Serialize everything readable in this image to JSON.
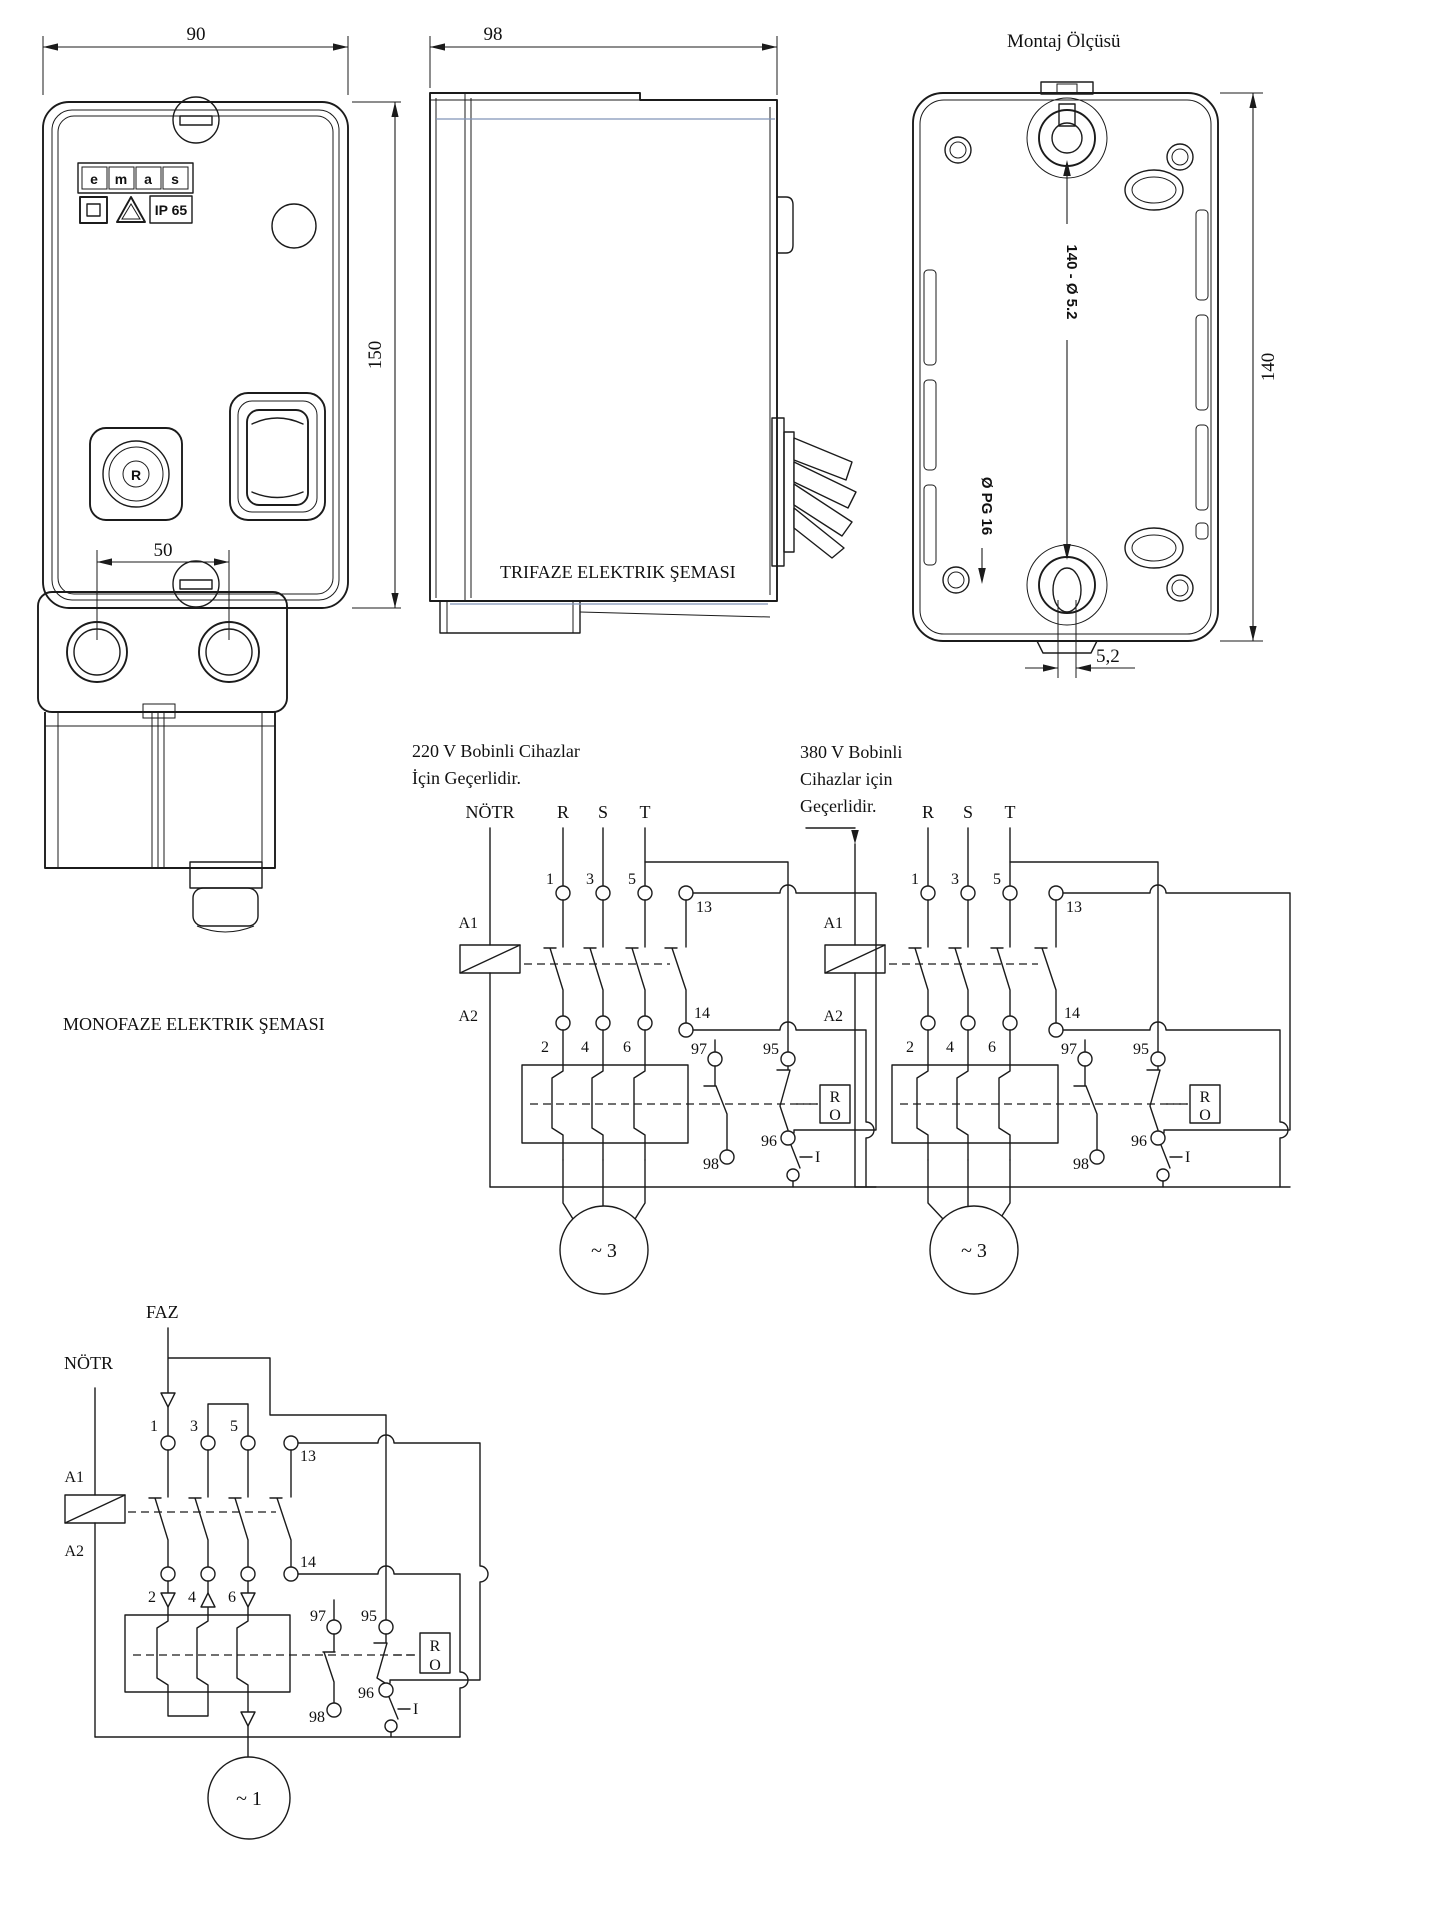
{
  "titles": {
    "montaj": "Montaj Ölçüsü",
    "trifaze": "TRIFAZE ELEKTRIK ŞEMASI",
    "monofaze": "MONOFAZE ELEKTRIK ŞEMASI"
  },
  "dimensions": {
    "front_width": "90",
    "front_height": "150",
    "side_depth": "98",
    "back_height": "140",
    "mount_holes": "140 - Ø 5.2",
    "cable_gland": "Ø PG 16",
    "slot_width": "5,2",
    "hole_centers": "50"
  },
  "front_view": {
    "logo_letters": [
      "e",
      "m",
      "a",
      "s"
    ],
    "ip_rating": "IP 65",
    "reset_button": "R"
  },
  "circuit_220": {
    "header_line1": "220 V Bobinli Cihazlar",
    "header_line2": "İçin Geçerlidir.",
    "neutral": "NÖTR"
  },
  "circuit_380": {
    "header_line1": "380 V Bobinli",
    "header_line2": "Cihazlar için",
    "header_line3": "Geçerlidir."
  },
  "circuit_mono": {
    "phase": "FAZ",
    "neutral": "NÖTR",
    "motor": "~ 1"
  },
  "shared": {
    "phase_r": "R",
    "phase_s": "S",
    "phase_t": "T",
    "t1": "1",
    "t2": "2",
    "t3": "3",
    "t4": "4",
    "t5": "5",
    "t6": "6",
    "aux_no": "13",
    "aux_nc": "14",
    "coil_a1": "A1",
    "coil_a2": "A2",
    "trip_95": "95",
    "trip_96": "96",
    "trip_97": "97",
    "trip_98": "98",
    "start": "I",
    "reset_r": "R",
    "reset_o": "O",
    "motor3": "~ 3"
  }
}
